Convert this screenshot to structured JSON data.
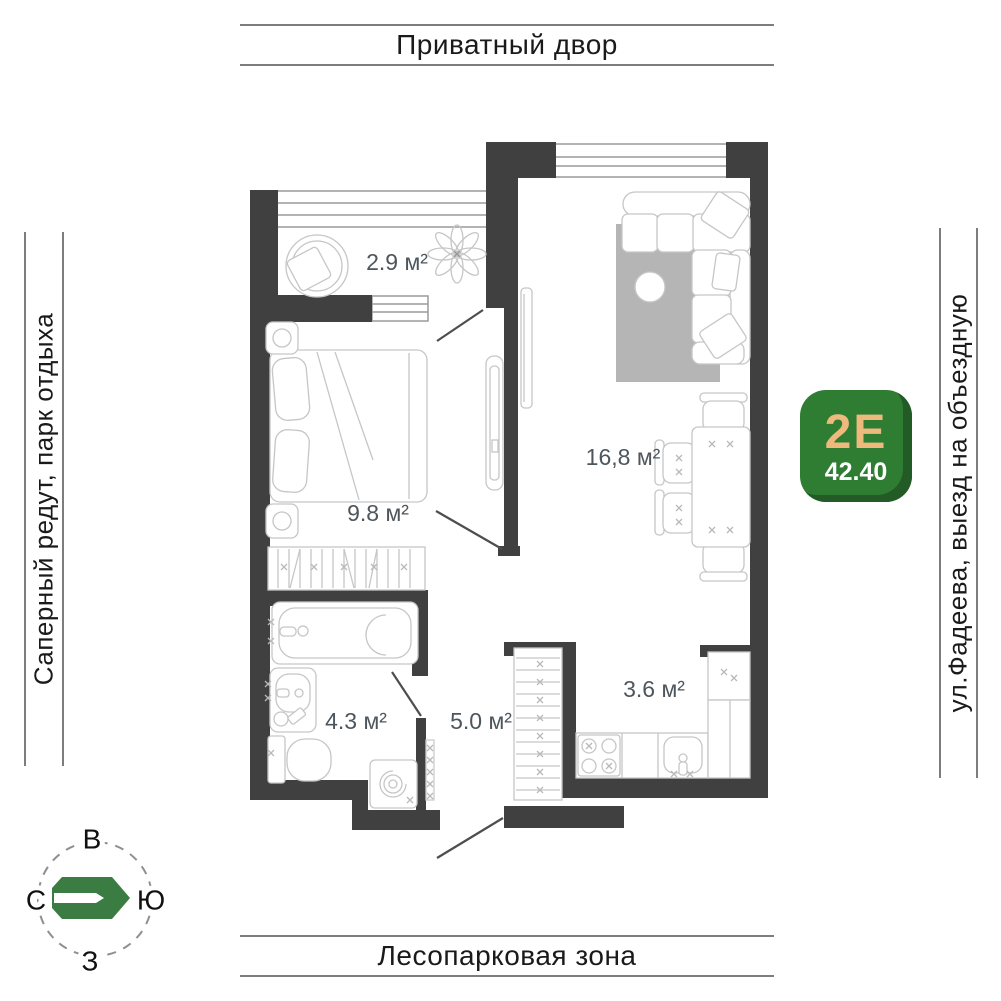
{
  "surroundings": {
    "top": "Приватный двор",
    "bottom": "Лесопарковая зона",
    "left": "Саперный редут, парк отдыха",
    "right": "ул.Фадеева, выезд на объездную"
  },
  "unit_badge": {
    "type_label": "2Е",
    "area_value": "42.40",
    "badge_color": "#2f7d33",
    "type_color": "#eeb97c",
    "area_color": "#ffffff"
  },
  "compass": {
    "top": "В",
    "left": "С",
    "right": "Ю",
    "bottom": "З",
    "logo_color": "#3a7c41"
  },
  "floor_plan": {
    "wall_color": "#404040",
    "furniture_line_color": "#c6c6c6",
    "rug_color": "#b5b5b5",
    "rooms": [
      {
        "id": "balcony",
        "area_label": "2.9 м²"
      },
      {
        "id": "bedroom",
        "area_label": "9.8 м²"
      },
      {
        "id": "living_room",
        "area_label": "16,8 м²"
      },
      {
        "id": "bathroom",
        "area_label": "4.3 м²"
      },
      {
        "id": "hallway",
        "area_label": "5.0 м²"
      },
      {
        "id": "kitchen",
        "area_label": "3.6 м²"
      }
    ]
  }
}
